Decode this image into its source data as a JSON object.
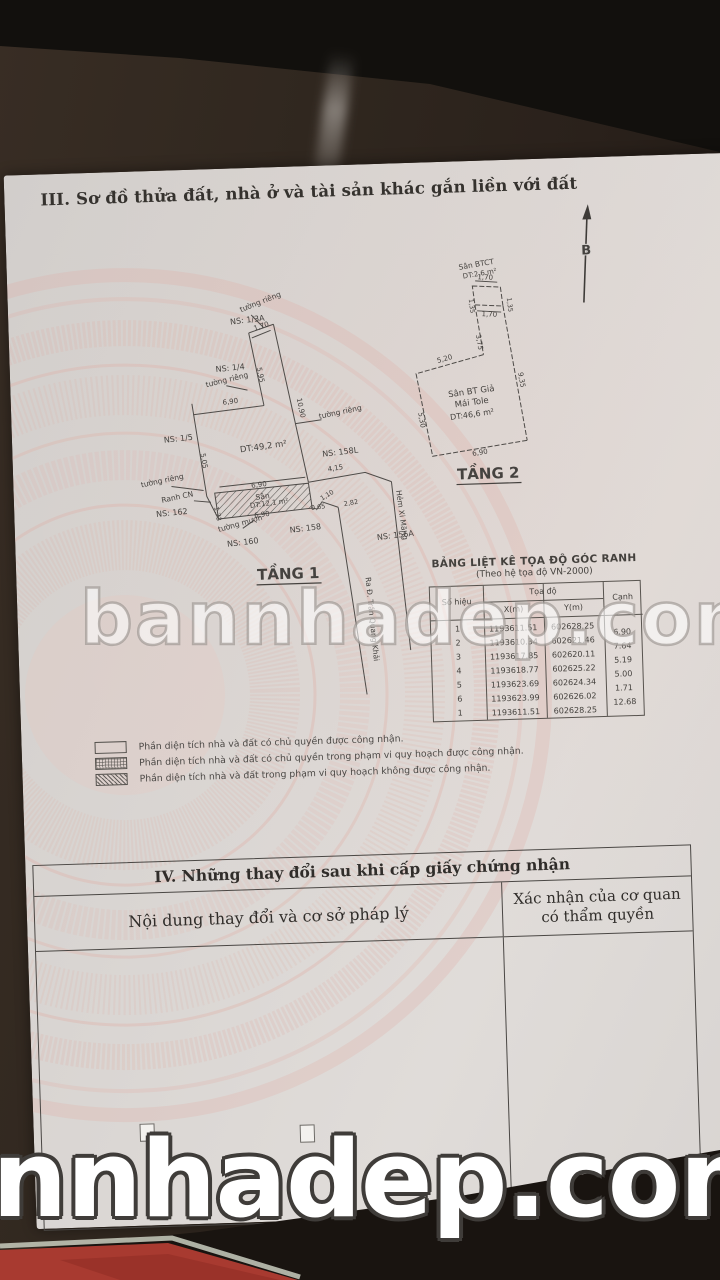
{
  "photo": {
    "paper_color": "#dad6d3",
    "table_color": "#2a211b",
    "emblem_pink": "#e4aca2",
    "book_red": "#a83a30",
    "ink_color": "#4a4744",
    "watermark_middle": "bannhadep.com",
    "watermark_bottom": "nnhadep.com"
  },
  "section3": {
    "title": "III. Sơ đồ thửa đất, nhà ở và tài sản khác gắn liền với đất",
    "north": "B",
    "plan1": {
      "title": "TẦNG 1",
      "area": "DT:49,2 m²",
      "yard_name": "Sân",
      "yard_area": "DT:12,1 m²",
      "ns_13a": "NS: 1/3A",
      "ns_14": "NS: 1/4",
      "ns_15": "NS: 1/5",
      "ns_158l": "NS: 158L",
      "ns_162": "NS: 162",
      "ns_160": "NS: 160",
      "ns_158": "NS: 158",
      "ns_156a": "NS: 156A",
      "wall_private": "tường riêng",
      "wall_borrowed": "tường mượn",
      "boundary": "Ranh CN",
      "lane": "Hẻm Xi Măng",
      "lane_dir": "Ra Đ. Trần Quang Khải",
      "d_170": "1,70",
      "d_690": "6,90",
      "d_1090": "10,90",
      "d_595": "5,95",
      "d_505": "5,05",
      "d_173": "1,73",
      "d_065": "0,65",
      "d_110": "1,10",
      "d_282": "2,82",
      "d_415": "4,15"
    },
    "plan2": {
      "title": "TẦNG 2",
      "top_name": "Sân BTCT",
      "top_area": "DT:2,6 m²",
      "main_name": "Sân BT Giả",
      "main_roof": "Mái Tole",
      "main_area": "DT:46,6 m²",
      "d_170": "1,70",
      "d_135": "1,35",
      "d_375": "3,75",
      "d_520": "5,20",
      "d_935": "9,35",
      "d_530": "5,30",
      "d_690": "6,90"
    },
    "coord_table": {
      "title": "BẢNG LIỆT KÊ TỌA ĐỘ GÓC RANH",
      "subtitle": "(Theo hệ tọa độ VN-2000)",
      "col_id": "Số hiệu",
      "col_coord": "Tọa độ",
      "col_x": "X(m)",
      "col_y": "Y(m)",
      "col_edge": "Cạnh",
      "rows": [
        {
          "id": "1",
          "x": "1193611.51",
          "y": "602628.25"
        },
        {
          "id": "2",
          "x": "1193610.34",
          "y": "602621.46"
        },
        {
          "id": "3",
          "x": "1193617.85",
          "y": "602620.11"
        },
        {
          "id": "4",
          "x": "1193618.77",
          "y": "602625.22"
        },
        {
          "id": "5",
          "x": "1193623.69",
          "y": "602624.34"
        },
        {
          "id": "6",
          "x": "1193623.99",
          "y": "602626.02"
        },
        {
          "id": "1",
          "x": "1193611.51",
          "y": "602628.25"
        }
      ],
      "edges": [
        "6.90",
        "7.64",
        "5.19",
        "5.00",
        "1.71",
        "12.68"
      ]
    },
    "legend": [
      {
        "text": "Phần diện tích nhà và đất có chủ quyền được công nhận."
      },
      {
        "text": "Phần diện tích nhà và đất có chủ quyền trong phạm vi quy hoạch được công nhận."
      },
      {
        "text": "Phần diện tích nhà và đất trong phạm vi quy hoạch không được công nhận."
      }
    ]
  },
  "section4": {
    "title": "IV. Những thay đổi sau khi cấp giấy chứng nhận",
    "col_left": "Nội dung thay đổi và cơ sở pháp lý",
    "col_right_1": "Xác nhận của cơ quan",
    "col_right_2": "có thẩm quyền"
  }
}
